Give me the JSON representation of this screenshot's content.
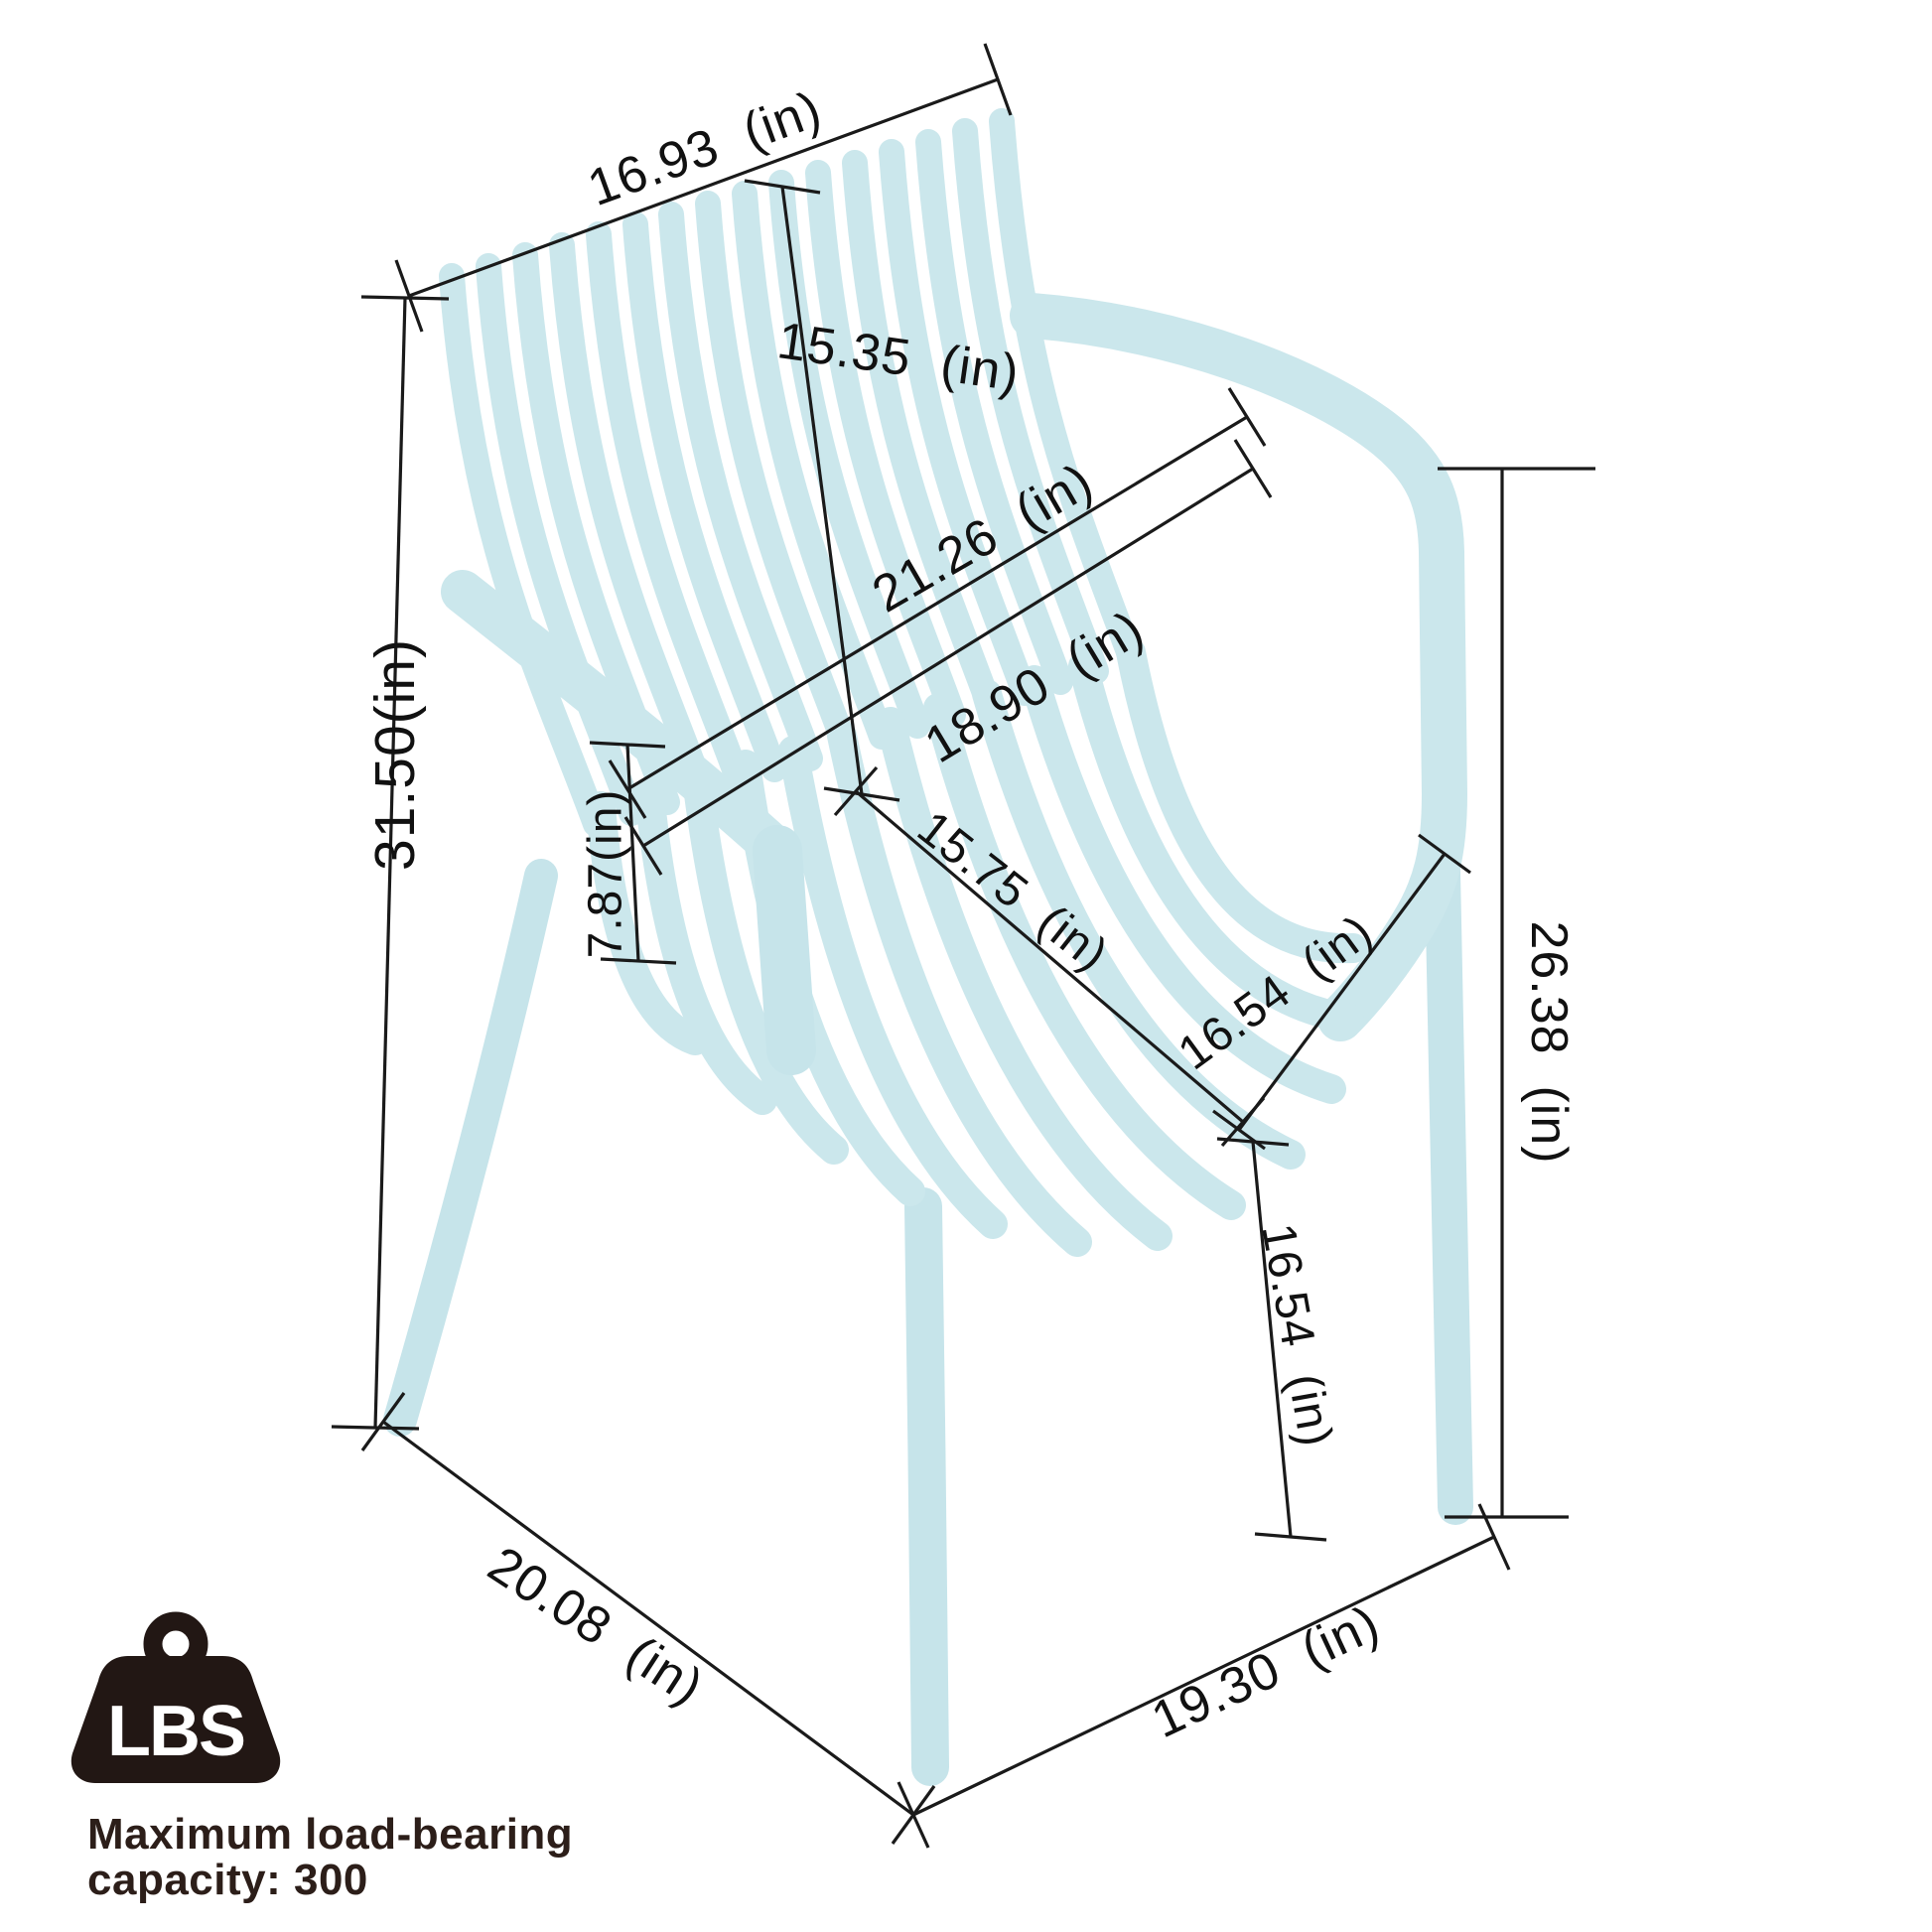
{
  "diagram": {
    "kind": "product-dimension-diagram",
    "unit": "in"
  },
  "dimensions": {
    "back_width": "16.93  (in)",
    "back_height": "15.35  (in)",
    "overall_width_upper": "21.26  (in)",
    "overall_width_lower": "18.90  (in)",
    "overall_height": "31.50(in)",
    "armrest_above_seat": "7.87(in)",
    "seat_depth": "15.75  (in)",
    "seat_width": "16.54  (in)",
    "armrest_floor_height": "26.38  (in)",
    "seat_floor_height": "16.54  (in)",
    "base_depth": "20.08  (in)",
    "base_width": "19.30  (in)"
  },
  "load_badge": {
    "icon": "weight-lbs-icon",
    "icon_text": "LBS",
    "caption_line1": "Maximum load-bearing",
    "caption_line2": "capacity: 300"
  },
  "colors": {
    "chair": "#cbe7ec",
    "dimension_lines": "#1a1a1a",
    "badge": "#221714",
    "badge_text": "#ffffff",
    "background": "#ffffff"
  }
}
